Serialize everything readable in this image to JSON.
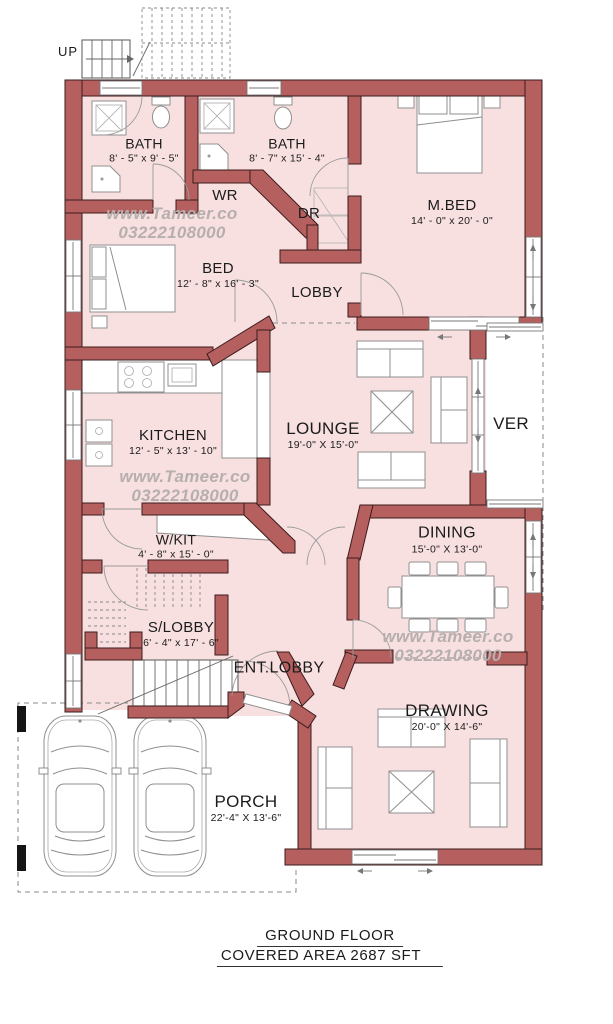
{
  "title": "Ground floor plan",
  "stairs": {
    "up_label": "UP"
  },
  "watermark": {
    "site": "www.Tameer.co",
    "phone": "03222108000"
  },
  "rooms": {
    "bath1": {
      "name": "BATH",
      "dims": "8' - 5\" x 9' - 5\""
    },
    "bath2": {
      "name": "BATH",
      "dims": "8' - 7\" x 15' - 4\""
    },
    "mbed": {
      "name": "M.BED",
      "dims": "14' - 0\" x 20' - 0\""
    },
    "wr": {
      "name": "WR"
    },
    "dr": {
      "name": "DR"
    },
    "bed": {
      "name": "BED",
      "dims": "12' - 8\" x 16' - 3\""
    },
    "lobby": {
      "name": "LOBBY"
    },
    "kitchen": {
      "name": "KITCHEN",
      "dims": "12' - 5\" x 13' - 10\""
    },
    "lounge": {
      "name": "LOUNGE",
      "dims": "19'-0\" X 15'-0\""
    },
    "ver": {
      "name": "VER"
    },
    "wkit": {
      "name": "W/KIT",
      "dims": "4' - 8\" x 15' - 0\""
    },
    "dining": {
      "name": "DINING",
      "dims": "15'-0\" X 13'-0\""
    },
    "slobby": {
      "name": "S/LOBBY",
      "dims": "6' - 4\" x 17' - 6\""
    },
    "entlobby": {
      "name": "ENT.LOBBY"
    },
    "drawing": {
      "name": "DRAWING",
      "dims": "20'-0\" X 14'-6\""
    },
    "porch": {
      "name": "PORCH",
      "dims": "22'-4\" X 13'-6\""
    }
  },
  "footer": {
    "line1": "GROUND FLOOR",
    "line2": "COVERED AREA  2687 SFT"
  },
  "colors": {
    "wall": "#b55f5f",
    "wall_outline": "#3b1c1c",
    "floor": "#f8e0e0",
    "furniture_line": "#8f8f8f",
    "text": "#1b1b1b",
    "watermark": "#b7aeae",
    "dashed_line": "#8a8a8a",
    "porch_post": "#151515"
  }
}
